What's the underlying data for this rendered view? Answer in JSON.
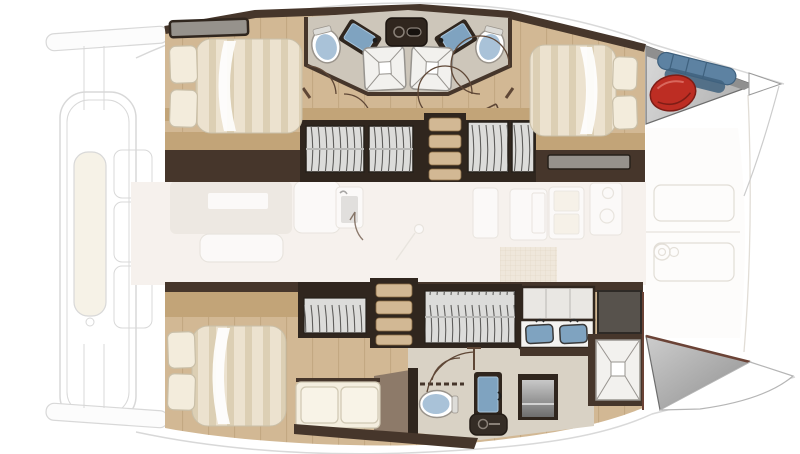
{
  "page": {
    "title": "Catamaran 3-cabin interior layout plan"
  },
  "plan": {
    "vessel_type": "catamaran",
    "areas": [
      {
        "name": "forward-deck-cockpit",
        "state": "faded",
        "fixtures": [
          "bench-cushion",
          "seat-outlines"
        ]
      },
      {
        "name": "port-hull-guest-cabins",
        "state": "focused",
        "fixtures": [
          "double-bed-left",
          "double-bed-right",
          "bathroom-left",
          "bathroom-right",
          "wardrobes",
          "staircase",
          "vanity-hatch"
        ]
      },
      {
        "name": "salon-galley",
        "state": "faded",
        "fixtures": [
          "dinette-table",
          "bench-seat",
          "galley-sink",
          "cabinets",
          "stove-burners",
          "floor-mat",
          "door-knob"
        ]
      },
      {
        "name": "starboard-hull-owner-cabin",
        "state": "focused",
        "fixtures": [
          "double-bed",
          "sofa",
          "wardrobe-small",
          "wardrobe-large",
          "staircase",
          "double-sink-counter",
          "toilet",
          "sink",
          "shower",
          "washing-machine",
          "locker-box"
        ]
      },
      {
        "name": "aft-cockpit",
        "state": "faded",
        "fixtures": [
          "bench-seats",
          "steering-wheel"
        ]
      },
      {
        "name": "bow-locker",
        "state": "focused",
        "fixtures": [
          "red-fender",
          "blue-fenders"
        ]
      },
      {
        "name": "stern-steps-wedge",
        "state": "focused",
        "fixtures": []
      }
    ],
    "counts": {
      "beds": 3,
      "toilets": 3,
      "showers": 3,
      "basins": 5,
      "staircases": 2
    }
  },
  "palette": {
    "white": "#ffffff",
    "wood": "#d2b894",
    "woodLine": "#8c6e46",
    "tanStrip": "#c2a478",
    "wall": "#46362b",
    "wallMid": "#6a5645",
    "frame": "#30261e",
    "louverBg": "#dcdcda",
    "louverLine": "#5f5e5c",
    "floorBath": "#cdc6ba",
    "floorBathB": "#d9d2c5",
    "mattress": "#ece2cf",
    "mattressStripe": "#dccfb4",
    "pillow": "#f3ecdc",
    "pillowEdge": "#c9bfa8",
    "cream": "#f4eedf",
    "cushionEdge": "#cfc7b2",
    "blueSink": "#7fa3c0",
    "blueSinkHi": "#a8c4da",
    "toiletLid": "#a9c2d8",
    "toiletRim": "#9a948c",
    "red": "#bd2d23",
    "redDark": "#7e1d16",
    "blueFender": "#5d82a2",
    "blueFenderDark": "#3f617e",
    "taupe": "#8d7a69",
    "grayCab": "#57524c",
    "grayPanel": "#96928c",
    "salonFloor": "#f3ede7",
    "salonFurniture": "#e3dcd2",
    "fadedLine": "#d8d2c9",
    "deckLine": "#cccccc",
    "gridTan": "#e6dac4",
    "gridLine": "#c9b48e",
    "hullEdge": "#b5b5b5",
    "brownEdge": "#6b4336",
    "steel": "#8f8f8f",
    "steelLight": "#cdcdcd",
    "showerLine": "#97948f",
    "trayWhite": "#f2f1ee",
    "doorArc": "#5f4736"
  }
}
